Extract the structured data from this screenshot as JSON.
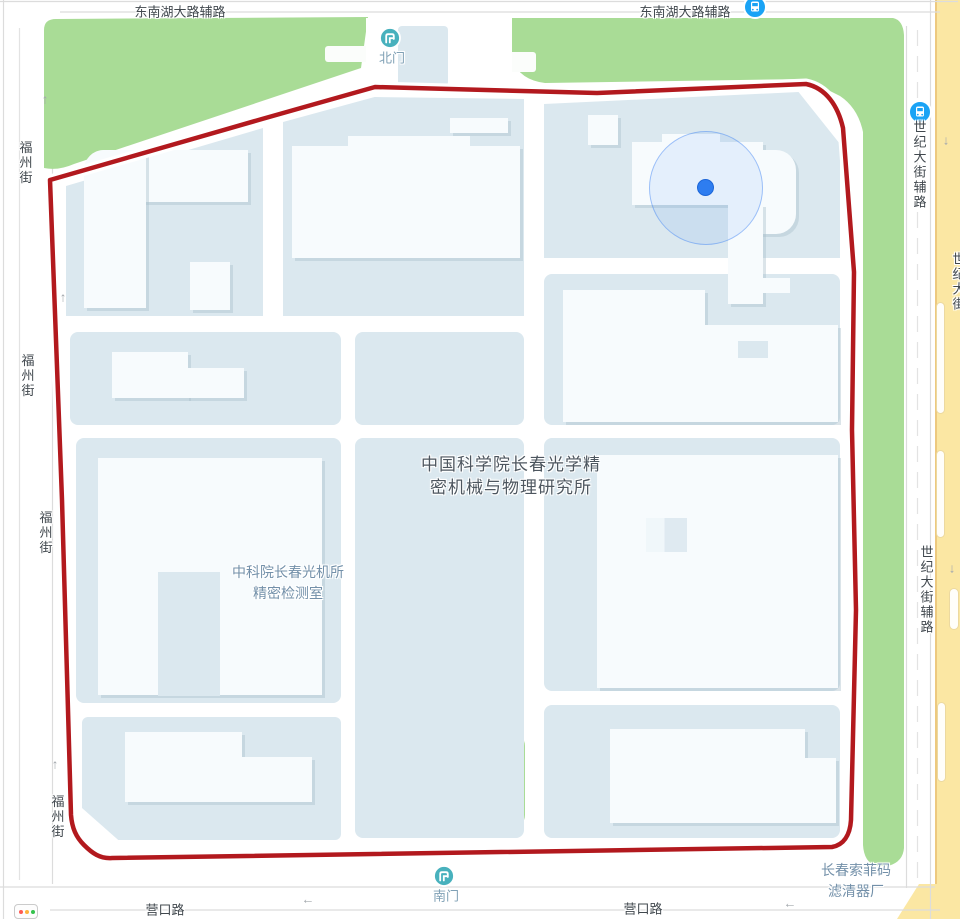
{
  "app": {
    "type": "map-view"
  },
  "colors": {
    "boundary_red": "#b2191e",
    "greenery": "#a9dc96",
    "parcel_blue": "#dbe8ef",
    "building_white": "#f7fbfd",
    "highway_yellow": "#fbe7a3",
    "location_blue": "#2e7df0",
    "gate_teal": "#48b1bd",
    "bus_blue": "#1aa3f5"
  },
  "roads": {
    "top": {
      "labels": [
        "东南湖大路辅路",
        "东南湖大路辅路"
      ]
    },
    "left": {
      "labels": [
        "福州街",
        "福州街",
        "福州街",
        "福州街"
      ]
    },
    "bottom": {
      "labels": [
        "营口路",
        "营口路"
      ]
    },
    "right_service": {
      "labels": [
        "世纪大街辅路",
        "世纪大街辅路"
      ]
    },
    "right_main": {
      "label": "世纪大街"
    }
  },
  "pois": {
    "institute": {
      "line1": "中国科学院长春光学精",
      "line2": "密机械与物理研究所"
    },
    "lab": {
      "line1": "中科院长春光机所",
      "line2": "精密检测室"
    },
    "factory": {
      "line1": "长春索菲码",
      "line2": "滤清器厂"
    },
    "north_gate": "北门",
    "south_gate": "南门"
  },
  "arrows": {
    "up": "↑",
    "down": "↓",
    "left": "←"
  },
  "icons": {
    "bus_stops": 2,
    "gates": 2,
    "traffic_light": 1,
    "location_marker": 1
  }
}
